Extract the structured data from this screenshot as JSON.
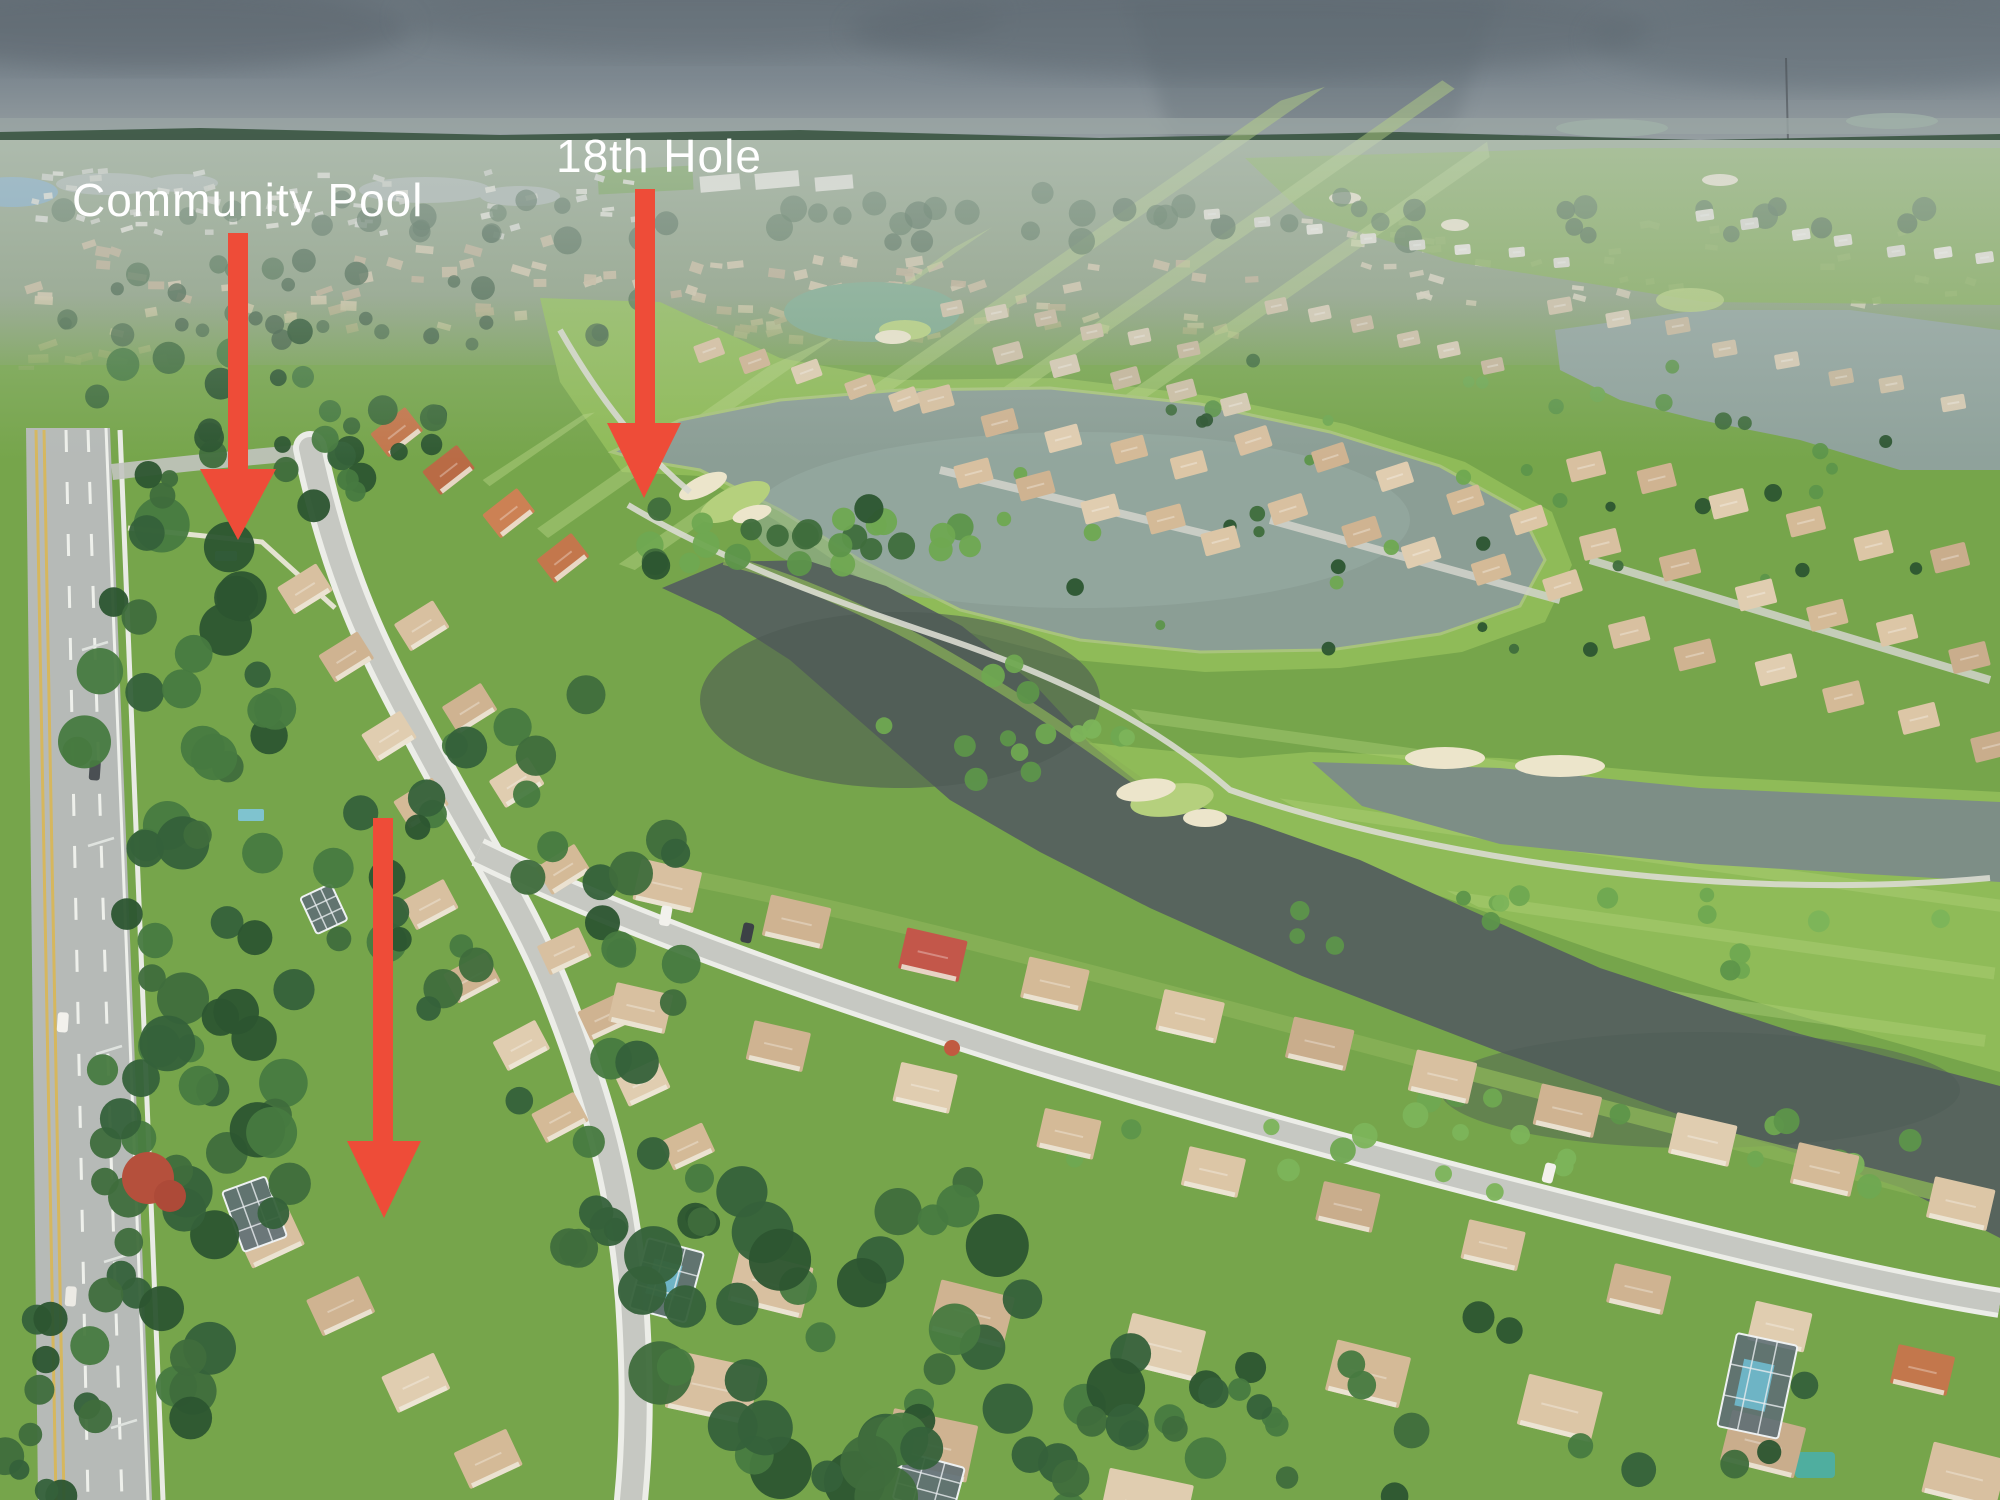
{
  "title": "Aerial photo of a Florida golf-course community with annotation arrows",
  "annotations": {
    "arrow_color": "#ee4c38",
    "text_color": "#ffffff",
    "labels": {
      "community_pool": "Community Pool",
      "hole_18": "18th Hole"
    },
    "items": [
      {
        "id": "community-pool",
        "label": "Community Pool",
        "points_to": "community pool area behind perimeter wall"
      },
      {
        "id": "18th-hole",
        "label": "18th Hole",
        "points_to": "18th green beside lake"
      },
      {
        "id": "subject-property",
        "label": "",
        "points_to": "tan-roof single family home"
      }
    ]
  },
  "scene": {
    "description": "High aerial view: tan-roofed homes along curving streets, dense tropical trees, golf fairways with sand bunkers, gray-green lakes, a dark canal, an arterial road on the left, hazy suburb and rain shaft on the horizon",
    "colors": {
      "sky_top": "#6b767e",
      "sky_horizon": "#a7aeae",
      "distant_land": "#8c9f82",
      "grass": "#76a54b",
      "fairway": "#8fbb58",
      "fairway_stripe": "#b9d685",
      "lake": "#8b9e95",
      "channel": "#7d8e86",
      "canal": "#57645d",
      "sand": "#ece5cb",
      "roof_tan": "#d8c0a0",
      "roof_orange": "#c3774c",
      "roof_red": "#c3574a",
      "street": "#c6c8c2",
      "sidewalk": "#ecede8",
      "road": "#b6bab7",
      "road_yellow": "#d6b75e",
      "tree_dark": "#2c5530",
      "tree_bright": "#6fa851",
      "pool_blue": "#6fb7c9"
    }
  }
}
